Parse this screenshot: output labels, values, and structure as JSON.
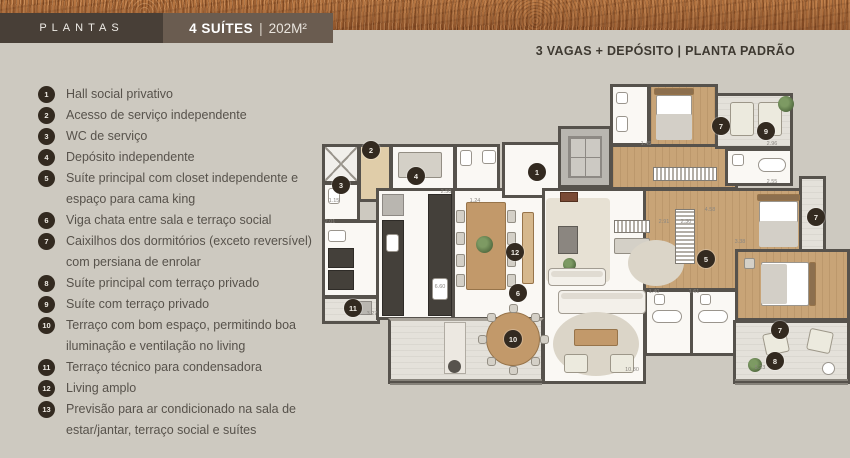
{
  "header": {
    "plantas_label": "PLANTAS",
    "unit_title": "4 SUÍTES",
    "divider": "|",
    "unit_area": "202M²",
    "right_info": "3 VAGAS + DEPÓSITO | PLANTA PADRÃO"
  },
  "legend": {
    "items": [
      {
        "n": "1",
        "text": "Hall social privativo"
      },
      {
        "n": "2",
        "text": "Acesso de serviço independente"
      },
      {
        "n": "3",
        "text": "WC de serviço"
      },
      {
        "n": "4",
        "text": "Depósito independente"
      },
      {
        "n": "5",
        "text": "Suíte principal com closet independente e espaço para cama king"
      },
      {
        "n": "6",
        "text": "Viga chata entre sala e terraço social"
      },
      {
        "n": "7",
        "text": "Caixilhos dos dormitórios (exceto reversível) com persiana de enrolar"
      },
      {
        "n": "8",
        "text": "Suíte principal com terraço privado"
      },
      {
        "n": "9",
        "text": "Suíte com terraço privado"
      },
      {
        "n": "10",
        "text": "Terraço com bom espaço, permitindo boa iluminação e ventilação no living"
      },
      {
        "n": "11",
        "text": "Terraço técnico para condensadora"
      },
      {
        "n": "12",
        "text": "Living amplo"
      },
      {
        "n": "13",
        "text": "Previsão para ar condicionado na sala de estar/jantar, terraço social e suítes"
      }
    ]
  },
  "floorplan": {
    "markers": [
      {
        "n": "1",
        "x": 217,
        "y": 90
      },
      {
        "n": "2",
        "x": 51,
        "y": 68
      },
      {
        "n": "3",
        "x": 21,
        "y": 103
      },
      {
        "n": "4",
        "x": 96,
        "y": 94
      },
      {
        "n": "5",
        "x": 386,
        "y": 177
      },
      {
        "n": "6",
        "x": 198,
        "y": 211
      },
      {
        "n": "7",
        "x": 401,
        "y": 44
      },
      {
        "n": "9",
        "x": 446,
        "y": 49
      },
      {
        "n": "7",
        "x": 496,
        "y": 135
      },
      {
        "n": "7",
        "x": 460,
        "y": 248
      },
      {
        "n": "8",
        "x": 455,
        "y": 279
      },
      {
        "n": "10",
        "x": 193,
        "y": 257
      },
      {
        "n": "11",
        "x": 33,
        "y": 226
      },
      {
        "n": "12",
        "x": 195,
        "y": 170
      }
    ],
    "dimensions": [
      {
        "v": "1.15",
        "x": 14,
        "y": 119
      },
      {
        "v": "2.01",
        "x": 10,
        "y": 140
      },
      {
        "v": "2.50",
        "x": 126,
        "y": 110
      },
      {
        "v": "1.24",
        "x": 155,
        "y": 119
      },
      {
        "v": "6.60",
        "x": 120,
        "y": 205
      },
      {
        "v": "3.27",
        "x": 52,
        "y": 232
      },
      {
        "v": "1.45",
        "x": 326,
        "y": 62
      },
      {
        "v": "2.96",
        "x": 452,
        "y": 62
      },
      {
        "v": "2.55",
        "x": 452,
        "y": 100
      },
      {
        "v": "2.91",
        "x": 344,
        "y": 140
      },
      {
        "v": "2.30",
        "x": 366,
        "y": 140
      },
      {
        "v": "4.58",
        "x": 390,
        "y": 128
      },
      {
        "v": "3.38",
        "x": 420,
        "y": 160
      },
      {
        "v": "1.40",
        "x": 334,
        "y": 210
      },
      {
        "v": "1.61",
        "x": 374,
        "y": 210
      },
      {
        "v": "10.80",
        "x": 312,
        "y": 288
      },
      {
        "v": "5.23",
        "x": 440,
        "y": 286
      }
    ]
  },
  "colors": {
    "accent_dark": "#483f37",
    "accent_mid": "#6a5c50",
    "page_bg": "#cdc9c0",
    "marker": "#332a20",
    "terracotta": "#a96b3e"
  }
}
